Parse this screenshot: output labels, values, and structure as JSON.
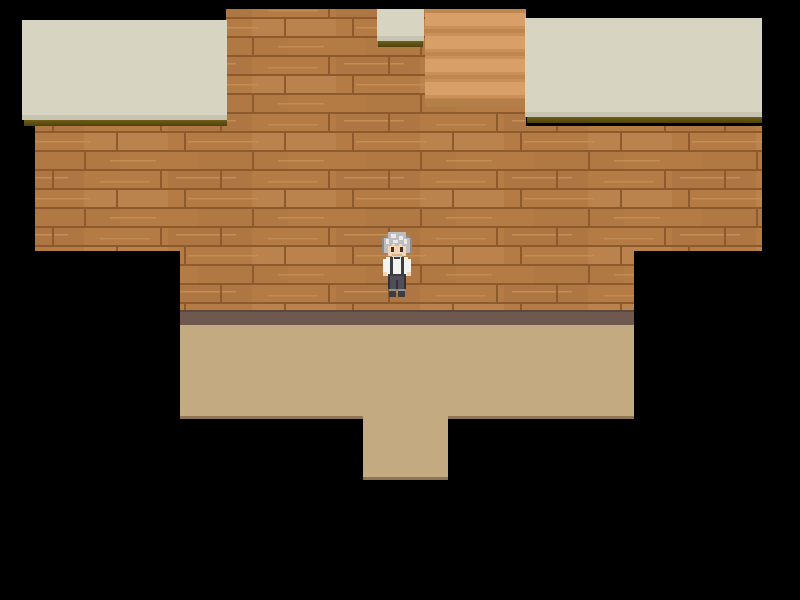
{
  "app": {
    "type": "rpg-game-screen",
    "title": "Top-down RPG map scene"
  },
  "scene": {
    "description": "Top-down RPG interior: brown wood-plank wall block on black void, light banded staircase at top, small pale ledge square and two wide pale roof ledges with dark olive drop shadows, purple-brown baseboard strip, tan floor with a narrower south exit corridor, and a single idle character facing down.",
    "character": {
      "name": "player",
      "appearance": "silver-gray spiky hair, pale skin, white shirt with dark suspenders, dark gray pants, gray shoes, facing down",
      "position": {
        "x": 379,
        "y": 232,
        "width": 36,
        "height": 66
      }
    },
    "regions": {
      "staircase": "light wood steps, top center-right",
      "ledges": "three pale beige roof/ledge slabs",
      "wall": "staggered wood plank wall",
      "floor": "tan floor with south exit opening"
    },
    "palette": {
      "void": "#000000",
      "wood-base": "#b57b45",
      "wood-line": "#8d5a2e",
      "wood-light": "#c9945c",
      "wood-dark": "#a87240",
      "stair-light": "#d89f68",
      "stair-mid": "#c99158",
      "stair-dark": "#bd874f",
      "stair-deep": "#b37e48",
      "ledge": "#d8d4c2",
      "ledge-edge": "#c8c4b2",
      "ledge-shadow-1": "#6f5e18",
      "ledge-shadow-2": "#4e420c",
      "baseboard": "#6f594e",
      "baseboard-top": "#5c483e",
      "floor": "#c3aa81",
      "floor-edge": "#8c7656",
      "hair-light": "#e9e9ea",
      "hair-mid": "#bdbdc0",
      "hair-dark": "#8b8b90",
      "skin": "#f2d6b4",
      "skin-shadow": "#d9b48d",
      "eye": "#3f3230",
      "shirt": "#f4f4f0",
      "shirt-shadow": "#d9d9d2",
      "strap": "#3c3c42",
      "pants": "#4f4f57",
      "pants-dark": "#303036",
      "shoe": "#3c3c41",
      "shoe-light": "#8f8f95"
    }
  }
}
